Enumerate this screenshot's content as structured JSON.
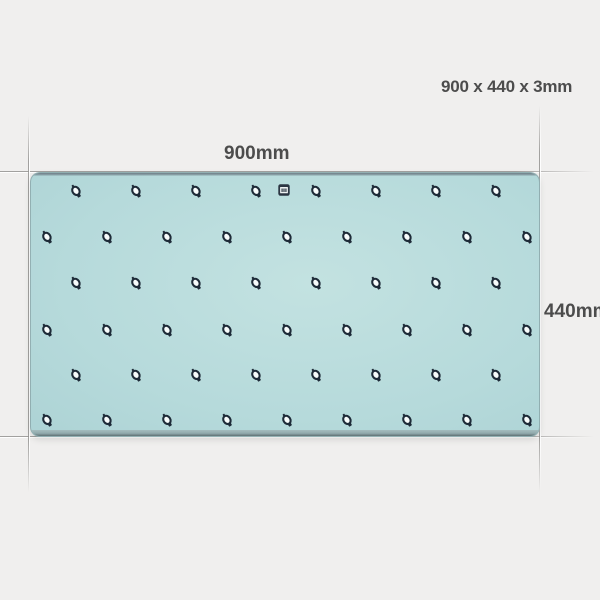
{
  "labels": {
    "spec": "900 x 440 x 3mm",
    "width": "900mm",
    "height": "440mm"
  },
  "colors": {
    "background": "#f0efee",
    "mat": "#b6dadb",
    "mat_center": "#c3e2e1",
    "mat_edge": "#91a9ac",
    "mat_top_line": "#6f7e87",
    "icon": "#1e2b38",
    "icon_face": "#f7fbfb",
    "logo_fill": "#2b3542",
    "logo_inner": "#eef2f2",
    "text": "#4c4c4c"
  },
  "pattern": {
    "icon_name": "watch-icon",
    "icon_size": 16,
    "spacing_x": 60,
    "rows": [
      {
        "y": 18,
        "start_x": 45,
        "count": 8
      },
      {
        "y": 64,
        "start_x": 16,
        "count": 9
      },
      {
        "y": 110,
        "start_x": 45,
        "count": 8
      },
      {
        "y": 157,
        "start_x": 16,
        "count": 9
      },
      {
        "y": 202,
        "start_x": 45,
        "count": 8
      },
      {
        "y": 247,
        "start_x": 16,
        "count": 9
      }
    ]
  },
  "logo": {
    "icon_name": "brand-logo-icon",
    "x": 253,
    "y": 16,
    "size": 12
  }
}
